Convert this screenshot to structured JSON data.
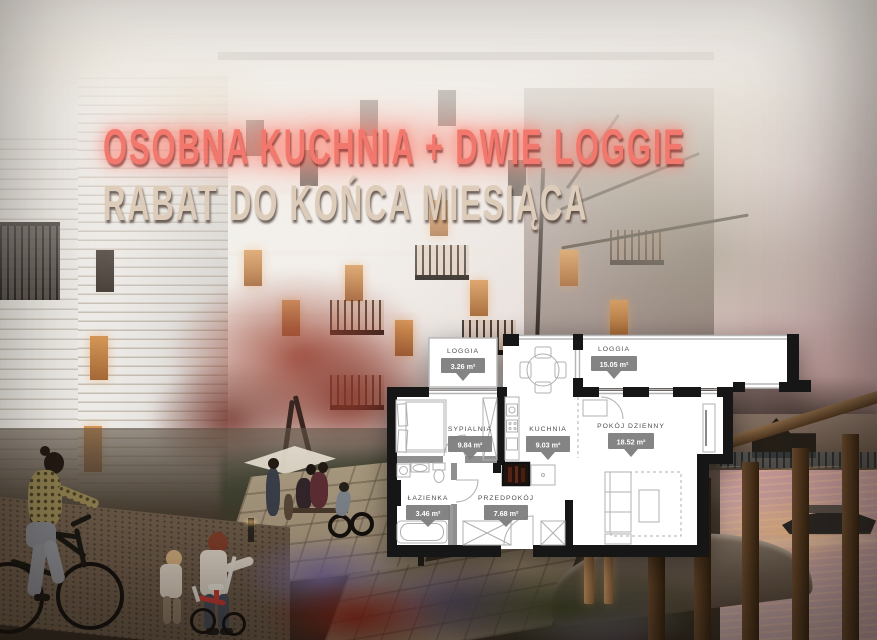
{
  "ad": {
    "headline_line1": "OSOBNA KUCHNIA + DWIE LOGGIE",
    "headline_line2": "RABAT DO KOŃCA MIESIĄCA"
  },
  "colors": {
    "headline1": "#f2786e",
    "headline2": "#ddccba",
    "badge_bg": "#7d7d7d",
    "badge_text": "#ffffff",
    "room_name_text": "#4f4f4f",
    "plan_wall": "#161616",
    "plan_floor": "#ffffff"
  },
  "floorplan": {
    "rooms": [
      {
        "name": "LOGGIA",
        "area": "3.26 m²"
      },
      {
        "name": "LOGGIA",
        "area": "15.05 m²"
      },
      {
        "name": "SYPIALNIA",
        "area": "9.84 m²"
      },
      {
        "name": "KUCHNIA",
        "area": "9.03 m²"
      },
      {
        "name": "POKÓJ DZIENNY",
        "area": "18.52 m²"
      },
      {
        "name": "ŁAZIENKA",
        "area": "3.46 m²"
      },
      {
        "name": "PRZEDPOKÓJ",
        "area": "7.68 m²"
      }
    ]
  }
}
